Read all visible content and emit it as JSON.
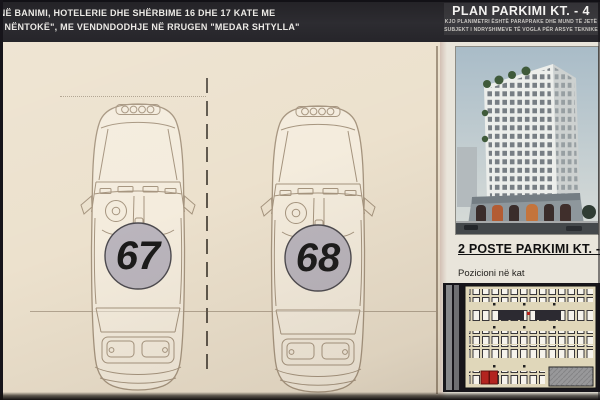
{
  "banner": {
    "project_line1": "INË BANIMI, HOTELERIE DHE SHËRBIME 16 DHE 17 KATE ME",
    "project_line2": "T NËNTOKË\", ME VENDNDODHJE NË RRUGEN \"MEDAR SHTYLLA\"",
    "plan_title": "PLAN PARKIMI KT. - 4",
    "disclaimer_line1": "KJO PLANIMETRI ËSHTË PARAPRAKE DHE MUND TË JETË",
    "disclaimer_line2": "SUBJEKT I NDRYSHIMEVE TË VOGLA PËR ARSYE TEKNIKE"
  },
  "parking_spots": [
    {
      "number": "67"
    },
    {
      "number": "68"
    }
  ],
  "side_panel": {
    "title": "2 POSTE  PARKIMI KT. -",
    "floor_label": "Pozicioni në kat"
  },
  "icons": {
    "car_brand": "audi-rings",
    "highlight": "red-highlighted-parking-spots"
  },
  "colors": {
    "paper": "#ece1cd",
    "banner_bg": "#2a292d",
    "badge_fill": "#bab5bd",
    "badge_border": "#4c4a4f",
    "car_line": "#a5947e",
    "highlight_red": "#b3241f",
    "panel_bg": "#e9e5db",
    "plan_floor": "#e0d7ba",
    "sky": "#aebfc9"
  }
}
